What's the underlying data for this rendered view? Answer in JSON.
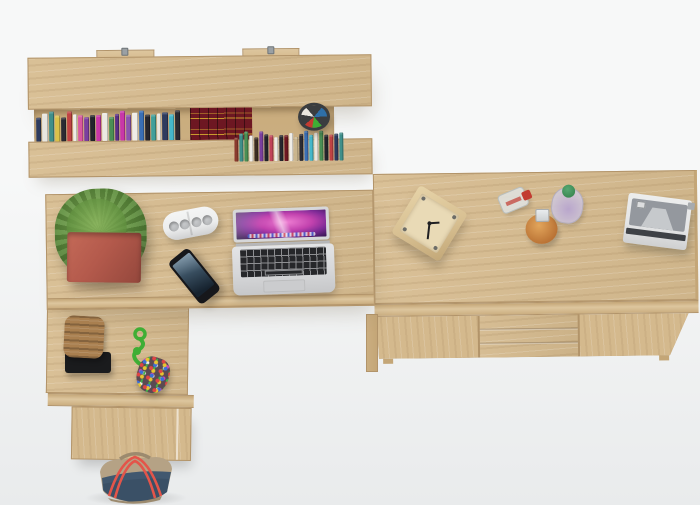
{
  "scene": {
    "subject": "Top-down product view of a light-oak home office set: wall shelf with books, L-shaped desk with laptop, and a sideboard",
    "furniture_finish": "light sonoma oak"
  },
  "palette": {
    "bg-1": "#f7f8f8",
    "bg-2": "#e9ebec",
    "oak": "#d7bc90",
    "oak-light": "#ddc69e",
    "oak-dark": "#c4a677",
    "oak-edge": "#cbae80",
    "oak-front": "#d4b98d",
    "oak-line": "#b2946a",
    "recess": "#c9ac7d",
    "soft-shadow": "rgba(125,112,90,0.30)",
    "metal": "#9aa0a4",
    "pot-red": "#b45a4c",
    "pot-red-dark": "#94473c",
    "leaf-dark": "#46702f",
    "leaf-mid": "#5f8f3e",
    "leaf-light": "#88b35c",
    "silver": "#d6d7d9",
    "silver-dark": "#b9babd",
    "key-dark": "#26272a",
    "key-line": "#8e8f92",
    "mac-pink": "#ef7fd3",
    "mac-magenta": "#c242ae",
    "mac-purple": "#7c2a96",
    "mac-dark": "#1d0e38",
    "phone-body": "#16171b",
    "phone-screen-1": "#59788f",
    "phone-screen-2": "#16222e",
    "speaker-body": "#eceded",
    "speaker-hole": "#b5b7b9",
    "handbag-red": "#d44c40",
    "handle-dark": "#2b2c30",
    "cubby-dark": "#0e0e10",
    "camera-dark": "#232327",
    "bookset-red": "#6d1722",
    "bookset-gold": "#c99a2e",
    "cup-dark": "#3a3d40",
    "basket-brown": "#a97f4f",
    "tray-dark": "#1a1b1d",
    "toy-green": "#3fae35",
    "pouch-base": "#5a4a52",
    "bead-1": "#e04444",
    "bead-2": "#e8c530",
    "bead-3": "#3a6fd8",
    "bead-4": "#42b24a",
    "bead-5": "#d348b8",
    "bead-6": "#f0ede6",
    "denim": "#41586f",
    "denim-dark": "#32465a",
    "khaki": "#b5a285",
    "khaki-dark": "#9c8a6e",
    "strap-red": "#e3554a",
    "clock-wood": "#d8c092",
    "clock-face": "#e9dab6",
    "hand-dark": "#1f1f22",
    "cap-red": "#c23b31",
    "bottle-orange-1": "#e2a55b",
    "bottle-orange-2": "#b2692d",
    "cap-silver": "#ccd0d2",
    "bottle-purple": "#b9a6cc",
    "cap-green": "#2f7d46",
    "radio-body": "#e4e5e6",
    "radio-front": "#94989e",
    "radio-light": "#c6c9cc",
    "radio-stripe": "#3e4146"
  },
  "wall_shelf": {
    "label": "wall shelf with two mounting hooks",
    "mount_hooks": 2,
    "books_top": [
      "#2e3b5e",
      "#e8e6e0",
      "#3f8f8a",
      "#d9c14a",
      "#2b2b33",
      "#c04343",
      "#efece6",
      "#d957a0",
      "#7a3f9e",
      "#23242c",
      "#c837a8",
      "#ece9e2",
      "#4a8f55",
      "#5a2f86",
      "#c837a8",
      "#8a55b0",
      "#f0ede7",
      "#3a6fb5",
      "#26262e",
      "#3f9f9a",
      "#e9e6df",
      "#2e3b5e",
      "#45b7c9",
      "#2a2a32"
    ],
    "books_bottom": [
      "#8a3b2e",
      "#3f8f8a",
      "#4a8f55",
      "#efece6",
      "#3a2c22",
      "#7a3f9e",
      "#23242c",
      "#c04358",
      "#ece9e2",
      "#26262e",
      "#6e1722",
      "#f0ede7",
      "#c9b58e",
      "#2b2b33",
      "#3a6fb5",
      "#45b7c9",
      "#e9e6df",
      "#4a8f55",
      "#23242c",
      "#c04343",
      "#2e3b5e",
      "#3f8f8a"
    ],
    "items": [
      "row of books",
      "dark red encyclopedia set",
      "pen cup",
      "white potted plant",
      "red handbag",
      "black camera"
    ]
  },
  "desk": {
    "label": "L-shaped desk",
    "items": [
      "green plant in red square pot",
      "white portable speaker",
      "black smartphone",
      "open laptop with pink aurora wallpaper",
      "woven basket on black tray",
      "green rope toy",
      "multicolor beaded pouch"
    ]
  },
  "sideboard": {
    "label": "sideboard with two doors and three drawers",
    "doors": 2,
    "drawers": 3,
    "items": [
      "wooden cube clock",
      "perfume bottle with red cap",
      "round amber bottle with silver cap",
      "perfume bottle with green cap",
      "white retro camera"
    ]
  },
  "floor": {
    "items": [
      "denim and khaki tote bag with red straps"
    ]
  }
}
